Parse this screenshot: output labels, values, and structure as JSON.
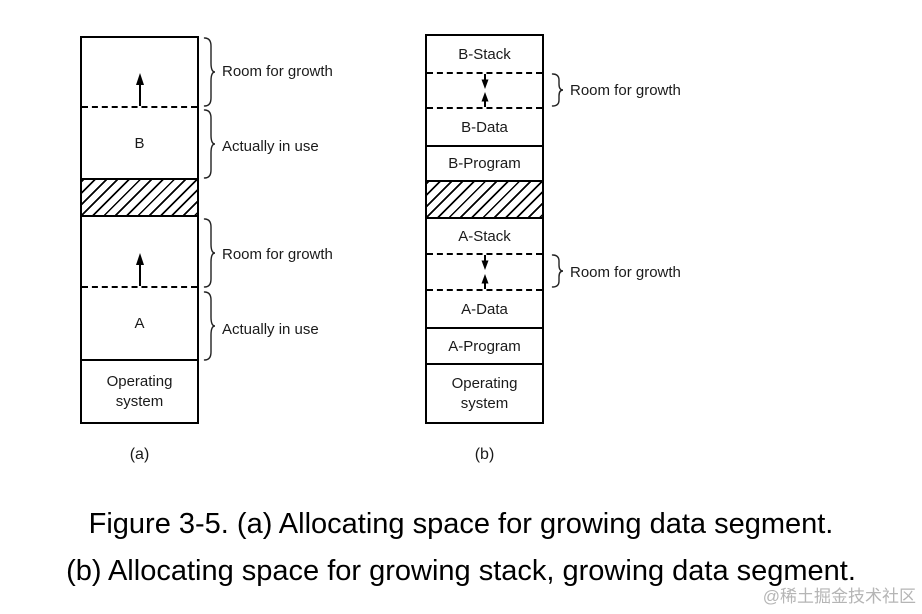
{
  "colors": {
    "line": "#000000",
    "background": "#ffffff",
    "watermark_gray": "#b5b5b5"
  },
  "diagram_a": {
    "caption_label": "(a)",
    "box": {
      "growth_b_annotation": "Room for growth",
      "b_label": "B",
      "b_annotation": "Actually in use",
      "growth_a_annotation": "Room for growth",
      "a_label": "A",
      "a_annotation": "Actually in use",
      "os_line1": "Operating",
      "os_line2": "system"
    }
  },
  "diagram_b": {
    "caption_label": "(b)",
    "box": {
      "b_stack": "B-Stack",
      "growth_b_annotation": "Room for growth",
      "b_data": "B-Data",
      "b_program": "B-Program",
      "a_stack": "A-Stack",
      "growth_a_annotation": "Room for growth",
      "a_data": "A-Data",
      "a_program": "A-Program",
      "os_line1": "Operating",
      "os_line2": "system"
    }
  },
  "caption": {
    "line1": "Figure 3-5. (a) Allocating space for growing data segment.",
    "line2": "(b) Allocating space for growing stack, growing data segment."
  },
  "watermark": "@稀土掘金技术社区"
}
